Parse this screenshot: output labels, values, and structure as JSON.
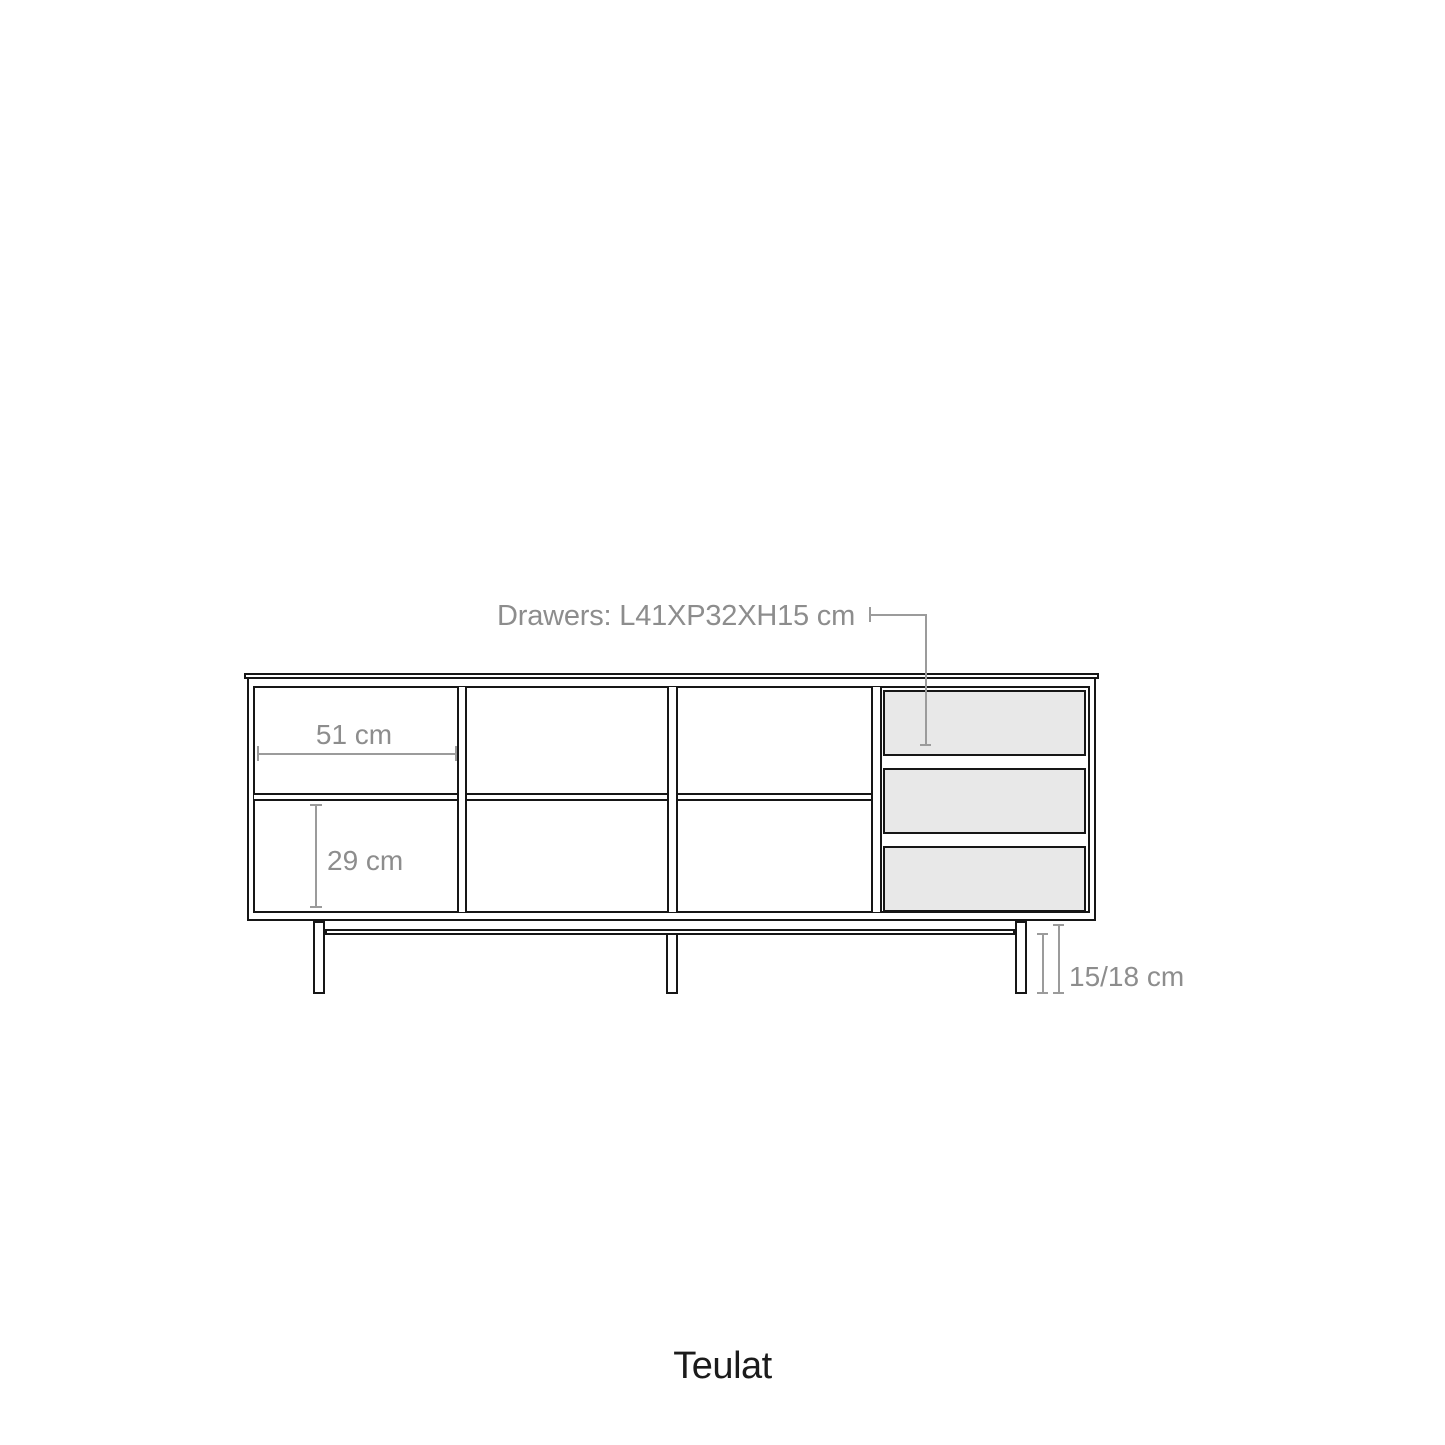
{
  "diagram": {
    "type": "furniture-dimension-drawing",
    "product": "sideboard with open compartments, three drawers and metal leg frame",
    "annotations": {
      "drawers_label": "Drawers: L41XP32XH15 cm",
      "compartment_width_label": "51 cm",
      "compartment_height_label": "29 cm",
      "leg_height_label": "15/18 cm"
    },
    "dimensions_cm": {
      "drawer_length": 41,
      "drawer_depth": 32,
      "drawer_height": 15,
      "compartment_width": 51,
      "compartment_height": 29,
      "leg_height_min": 15,
      "leg_height_max": 18
    },
    "structure": {
      "open_columns": 3,
      "rows_per_open_column": 2,
      "drawer_count": 3,
      "leg_count": 3
    },
    "colors": {
      "line": "#161616",
      "dimension_line": "#9b9b9b",
      "dimension_text": "#8d8d8d",
      "drawer_fill": "#e8e8e8",
      "background": "#ffffff"
    }
  },
  "brand": {
    "name": "Teulat"
  }
}
